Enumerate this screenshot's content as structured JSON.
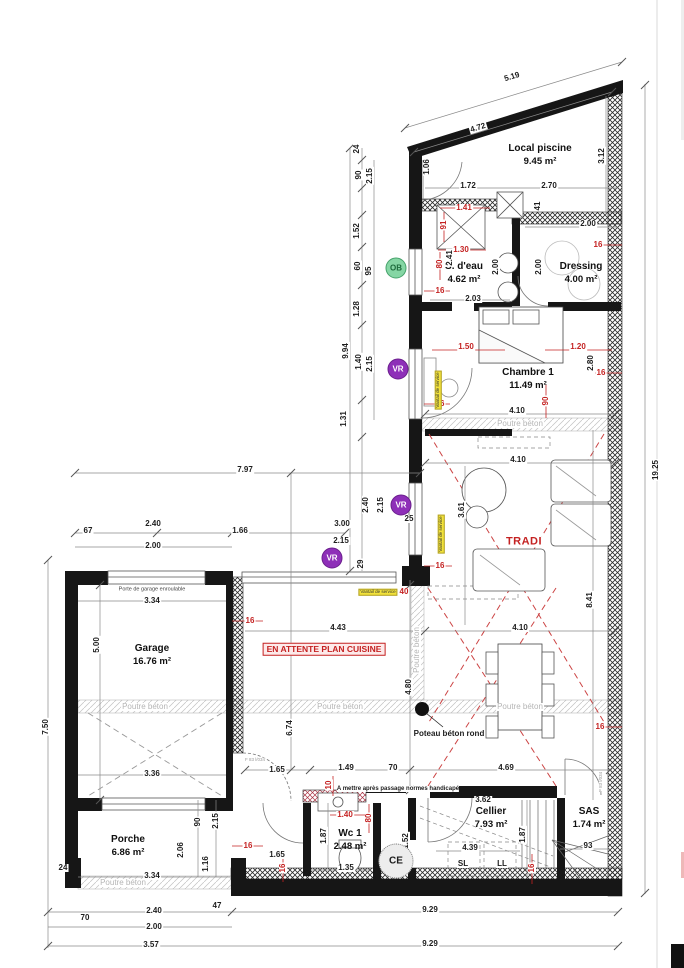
{
  "plan": {
    "rooms": [
      {
        "name": "Local piscine",
        "area": "9.45 m²",
        "x": 540,
        "y": 155
      },
      {
        "name": "S. d'eau",
        "area": "4.62 m²",
        "x": 464,
        "y": 273
      },
      {
        "name": "Dressing",
        "area": "4.00 m²",
        "x": 581,
        "y": 273
      },
      {
        "name": "Chambre 1",
        "area": "11.49 m²",
        "x": 528,
        "y": 379
      },
      {
        "name": "Garage",
        "area": "16.76 m²",
        "x": 152,
        "y": 655
      },
      {
        "name": "Porche",
        "area": "6.86 m²",
        "x": 128,
        "y": 846
      },
      {
        "name": "Wc 1",
        "area": "2.48 m²",
        "x": 350,
        "y": 840
      },
      {
        "name": "Cellier",
        "area": "7.93 m²",
        "x": 491,
        "y": 818
      },
      {
        "name": "SAS",
        "area": "1.74 m²",
        "x": 589,
        "y": 818
      }
    ],
    "dims": [
      {
        "t": "5.19",
        "x": 512,
        "y": 77,
        "r": -17
      },
      {
        "t": "4.72",
        "x": 478,
        "y": 128,
        "r": -17
      },
      {
        "t": "3.12",
        "x": 602,
        "y": 156,
        "r": -90
      },
      {
        "t": "1.06",
        "x": 427,
        "y": 167,
        "r": -90
      },
      {
        "t": "1.72",
        "x": 468,
        "y": 186,
        "r": 0
      },
      {
        "t": "2.70",
        "x": 549,
        "y": 186,
        "r": 0
      },
      {
        "t": "41",
        "x": 538,
        "y": 206,
        "r": -90
      },
      {
        "t": "2.00",
        "x": 588,
        "y": 224,
        "r": 0
      },
      {
        "t": "2.00",
        "x": 496,
        "y": 267,
        "r": -90
      },
      {
        "t": "2.00",
        "x": 539,
        "y": 267,
        "r": -90
      },
      {
        "t": "2.41",
        "x": 450,
        "y": 258,
        "r": -90
      },
      {
        "t": "2.03",
        "x": 473,
        "y": 299,
        "r": 0
      },
      {
        "t": "2.80",
        "x": 591,
        "y": 363,
        "r": -90
      },
      {
        "t": "4.10",
        "x": 517,
        "y": 411,
        "r": 0
      },
      {
        "t": "4.10",
        "x": 518,
        "y": 460,
        "r": 0
      },
      {
        "t": "3.61",
        "x": 462,
        "y": 510,
        "r": -90
      },
      {
        "t": "8.41",
        "x": 590,
        "y": 600,
        "r": -90
      },
      {
        "t": "4.10",
        "x": 520,
        "y": 628,
        "r": 0
      },
      {
        "t": "4.43",
        "x": 338,
        "y": 628,
        "r": 0
      },
      {
        "t": "4.80",
        "x": 409,
        "y": 687,
        "r": -90
      },
      {
        "t": "6.74",
        "x": 290,
        "y": 728,
        "r": -90
      },
      {
        "t": "19.25",
        "x": 656,
        "y": 470,
        "r": -90
      },
      {
        "t": "9.94",
        "x": 346,
        "y": 351,
        "r": -90
      },
      {
        "t": "24",
        "x": 357,
        "y": 149,
        "r": -90
      },
      {
        "t": "90",
        "x": 359,
        "y": 175,
        "r": -90
      },
      {
        "t": "2.15",
        "x": 370,
        "y": 176,
        "r": -90
      },
      {
        "t": "1.52",
        "x": 357,
        "y": 231,
        "r": -90
      },
      {
        "t": "60",
        "x": 358,
        "y": 266,
        "r": -90
      },
      {
        "t": "95",
        "x": 369,
        "y": 271,
        "r": -90
      },
      {
        "t": "1.28",
        "x": 357,
        "y": 309,
        "r": -90
      },
      {
        "t": "1.40",
        "x": 359,
        "y": 362,
        "r": -90
      },
      {
        "t": "2.15",
        "x": 370,
        "y": 364,
        "r": -90
      },
      {
        "t": "1.31",
        "x": 344,
        "y": 419,
        "r": -90
      },
      {
        "t": "7.97",
        "x": 245,
        "y": 470,
        "r": 0
      },
      {
        "t": "67",
        "x": 88,
        "y": 531,
        "r": 0
      },
      {
        "t": "2.40",
        "x": 153,
        "y": 524,
        "r": 0
      },
      {
        "t": "2.00",
        "x": 153,
        "y": 546,
        "r": 0
      },
      {
        "t": "1.66",
        "x": 240,
        "y": 531,
        "r": 0
      },
      {
        "t": "3.00",
        "x": 342,
        "y": 524,
        "r": 0
      },
      {
        "t": "2.15",
        "x": 341,
        "y": 541,
        "r": 0
      },
      {
        "t": "2.40",
        "x": 366,
        "y": 505,
        "r": -90
      },
      {
        "t": "2.15",
        "x": 381,
        "y": 505,
        "r": -90
      },
      {
        "t": "25",
        "x": 409,
        "y": 519,
        "r": 0
      },
      {
        "t": "29",
        "x": 361,
        "y": 564,
        "r": -90
      },
      {
        "t": "3.34",
        "x": 152,
        "y": 601,
        "r": 0
      },
      {
        "t": "5.00",
        "x": 97,
        "y": 645,
        "r": -90
      },
      {
        "t": "3.36",
        "x": 152,
        "y": 774,
        "r": 0
      },
      {
        "t": "7.50",
        "x": 46,
        "y": 727,
        "r": -90
      },
      {
        "t": "1.65",
        "x": 277,
        "y": 770,
        "r": 0
      },
      {
        "t": "1.49",
        "x": 346,
        "y": 768,
        "r": 0
      },
      {
        "t": "70",
        "x": 393,
        "y": 768,
        "r": 0
      },
      {
        "t": "4.69",
        "x": 506,
        "y": 768,
        "r": 0
      },
      {
        "t": "90",
        "x": 198,
        "y": 822,
        "r": -90
      },
      {
        "t": "2.15",
        "x": 216,
        "y": 821,
        "r": -90
      },
      {
        "t": "2.06",
        "x": 181,
        "y": 850,
        "r": -90
      },
      {
        "t": "1.16",
        "x": 206,
        "y": 864,
        "r": -90
      },
      {
        "t": "3.34",
        "x": 152,
        "y": 876,
        "r": 0
      },
      {
        "t": "24",
        "x": 63,
        "y": 868,
        "r": 0
      },
      {
        "t": "1.87",
        "x": 324,
        "y": 836,
        "r": -90
      },
      {
        "t": "1.35",
        "x": 346,
        "y": 868,
        "r": 0
      },
      {
        "t": "1.52",
        "x": 406,
        "y": 841,
        "r": -90
      },
      {
        "t": "3.62",
        "x": 483,
        "y": 800,
        "r": 0
      },
      {
        "t": "4.39",
        "x": 470,
        "y": 848,
        "r": 0
      },
      {
        "t": "1.87",
        "x": 523,
        "y": 835,
        "r": -90
      },
      {
        "t": "93",
        "x": 588,
        "y": 846,
        "r": 0
      },
      {
        "t": "1.65",
        "x": 277,
        "y": 855,
        "r": 0
      },
      {
        "t": "47",
        "x": 217,
        "y": 906,
        "r": 0
      },
      {
        "t": "2.40",
        "x": 154,
        "y": 911,
        "r": 0
      },
      {
        "t": "70",
        "x": 85,
        "y": 918,
        "r": 0
      },
      {
        "t": "2.00",
        "x": 154,
        "y": 927,
        "r": 0
      },
      {
        "t": "3.57",
        "x": 151,
        "y": 945,
        "r": 0
      },
      {
        "t": "9.29",
        "x": 430,
        "y": 910,
        "r": 0
      },
      {
        "t": "9.29",
        "x": 430,
        "y": 944,
        "r": 0
      }
    ],
    "dims_red": [
      {
        "t": "1.41",
        "x": 464,
        "y": 208,
        "r": 0
      },
      {
        "t": "91",
        "x": 444,
        "y": 225,
        "r": -90
      },
      {
        "t": "1.30",
        "x": 461,
        "y": 250,
        "r": 0
      },
      {
        "t": "80",
        "x": 440,
        "y": 264,
        "r": -90
      },
      {
        "t": "16",
        "x": 440,
        "y": 291,
        "r": 0
      },
      {
        "t": "16",
        "x": 598,
        "y": 245,
        "r": 0
      },
      {
        "t": "1.50",
        "x": 466,
        "y": 347,
        "r": 0
      },
      {
        "t": "1.20",
        "x": 578,
        "y": 347,
        "r": 0
      },
      {
        "t": "16",
        "x": 601,
        "y": 373,
        "r": 0
      },
      {
        "t": "16",
        "x": 440,
        "y": 404,
        "r": 0
      },
      {
        "t": "90",
        "x": 546,
        "y": 401,
        "r": -90
      },
      {
        "t": "16",
        "x": 440,
        "y": 566,
        "r": 0
      },
      {
        "t": "16",
        "x": 250,
        "y": 621,
        "r": 0
      },
      {
        "t": "40",
        "x": 404,
        "y": 592,
        "r": 0
      },
      {
        "t": "16",
        "x": 600,
        "y": 727,
        "r": 0
      },
      {
        "t": "10",
        "x": 329,
        "y": 785,
        "r": -90
      },
      {
        "t": "1.40",
        "x": 345,
        "y": 815,
        "r": 0
      },
      {
        "t": "80",
        "x": 369,
        "y": 818,
        "r": -90
      },
      {
        "t": "16",
        "x": 248,
        "y": 846,
        "r": 0
      },
      {
        "t": "16",
        "x": 283,
        "y": 868,
        "r": -90
      },
      {
        "t": "16",
        "x": 532,
        "y": 868,
        "r": -90
      }
    ],
    "beams": [
      {
        "t": "Poutre béton",
        "x": 520,
        "y": 424,
        "r": 0
      },
      {
        "t": "Poutre béton",
        "x": 145,
        "y": 707,
        "r": 0
      },
      {
        "t": "Poutre béton",
        "x": 340,
        "y": 707,
        "r": 0
      },
      {
        "t": "Poutre béton",
        "x": 520,
        "y": 707,
        "r": 0
      },
      {
        "t": "Poutre béton",
        "x": 123,
        "y": 883,
        "r": 0
      },
      {
        "t": "Poutre béton",
        "x": 417,
        "y": 650,
        "r": -90
      }
    ],
    "notes": {
      "kitchen": "EN ATTENTE PLAN CUISINE",
      "tradi": "TRADI",
      "post": "Poteau béton rond",
      "handicap": "A mettre après passage normes handicapé",
      "garage_door": "Porte de garage enroulable"
    },
    "badges": [
      {
        "t": "OB",
        "kind": "ob",
        "x": 396,
        "y": 268
      },
      {
        "t": "VR",
        "kind": "vr",
        "x": 398,
        "y": 369
      },
      {
        "t": "VR",
        "kind": "vr",
        "x": 401,
        "y": 505
      },
      {
        "t": "VR",
        "kind": "vr",
        "x": 332,
        "y": 558
      },
      {
        "t": "CE",
        "kind": "ce",
        "x": 396,
        "y": 861
      }
    ],
    "tags": [
      {
        "t": "Vantail de service",
        "x": 438,
        "y": 390,
        "r": -90
      },
      {
        "t": "Vantail de service",
        "x": 441,
        "y": 534,
        "r": -90
      },
      {
        "t": "Vantail de service",
        "x": 378,
        "y": 592,
        "r": 0
      }
    ],
    "codes": [
      {
        "t": "F 83 l/034",
        "x": 255,
        "y": 760,
        "r": 0
      },
      {
        "t": "P 83 l/034",
        "x": 601,
        "y": 782,
        "r": -90
      }
    ],
    "appliances": [
      {
        "t": "SL",
        "x": 463,
        "y": 864
      },
      {
        "t": "LL",
        "x": 502,
        "y": 864
      }
    ],
    "colors": {
      "wall": "#161616",
      "red": "#c42222",
      "beam_text": "#b5b5b5",
      "ob_green": "#85d6a4",
      "vr_purple": "#8e2fb8",
      "tag_yellow": "#f2e23a"
    }
  }
}
